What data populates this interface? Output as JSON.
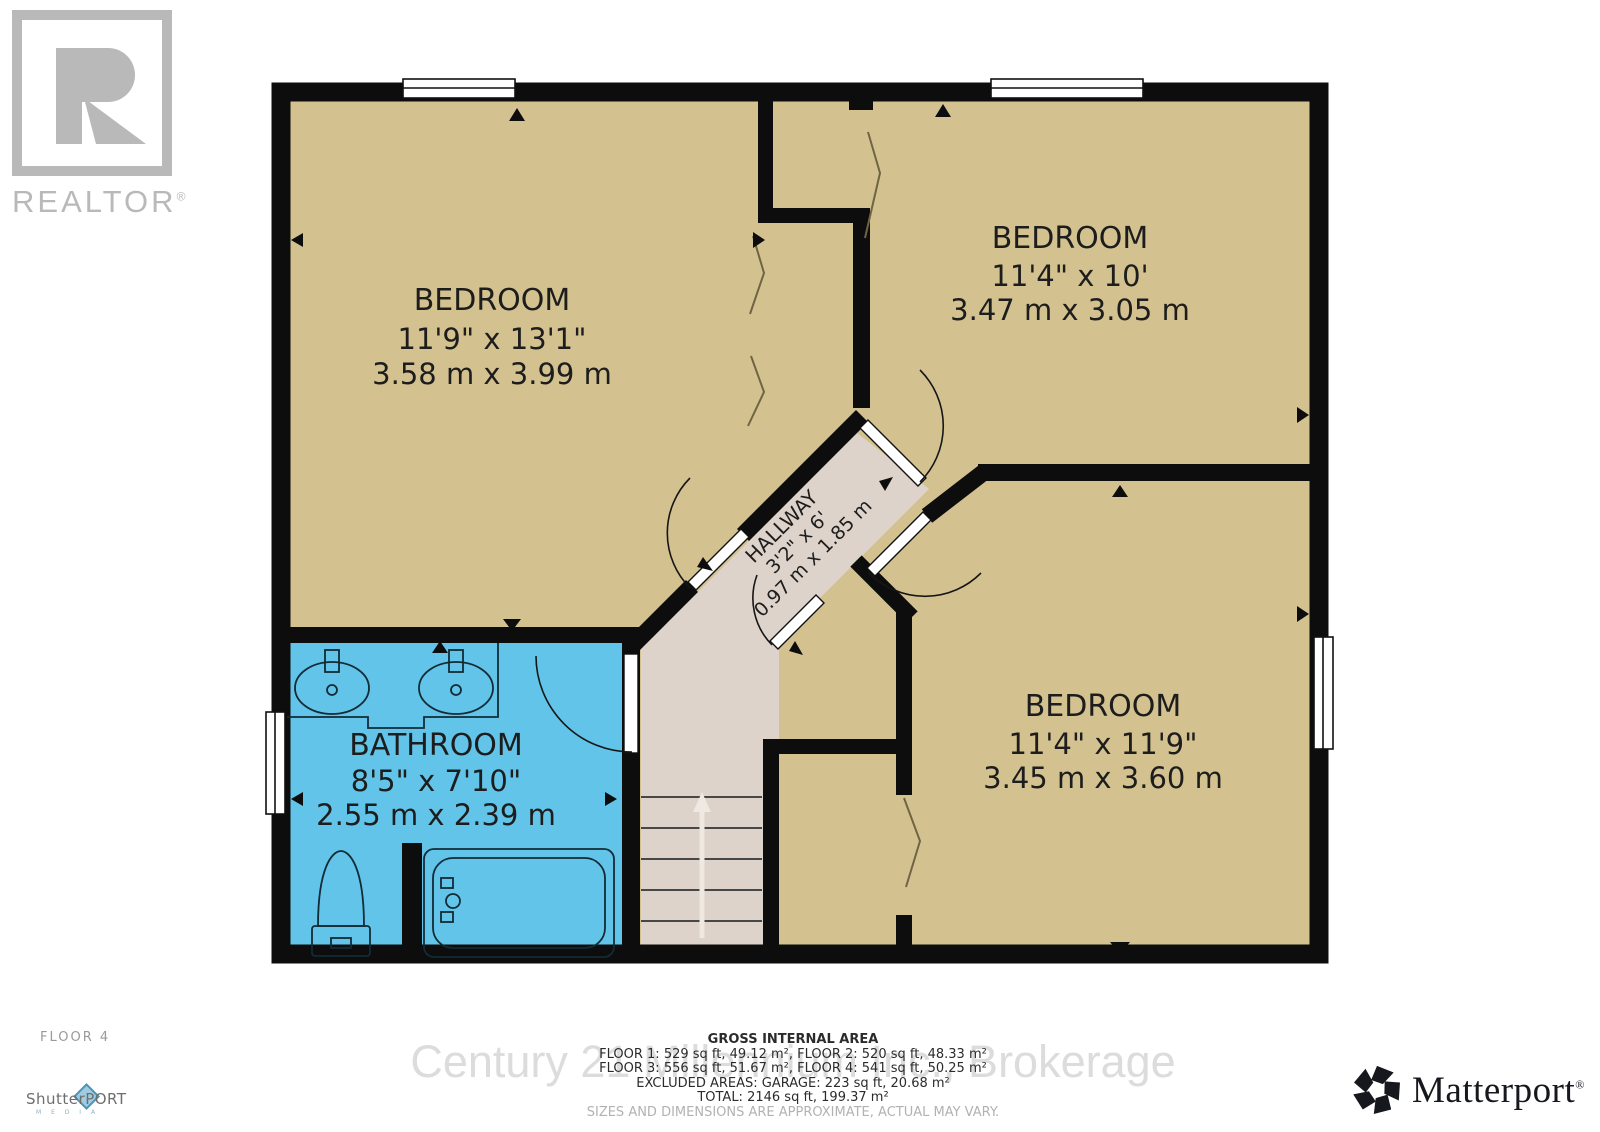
{
  "branding": {
    "realtor_wordmark": "REALTOR",
    "realtor_reg": "®",
    "shutterport_wordmark": "ShutterPORT",
    "shutterport_sub": "M E D I A",
    "matterport_wordmark": "Matterport",
    "matterport_reg": "®"
  },
  "floor_label": "FLOOR 4",
  "watermark": "Century 21 Millennium Inc., Brokerage",
  "rooms": {
    "bedroom_top_left": {
      "name": "BEDROOM",
      "dim_ft": "11'9\" x 13'1\"",
      "dim_m": "3.58 m x 3.99 m"
    },
    "bedroom_top_right": {
      "name": "BEDROOM",
      "dim_ft": "11'4\" x 10'",
      "dim_m": "3.47 m x 3.05 m"
    },
    "bedroom_bottom_right": {
      "name": "BEDROOM",
      "dim_ft": "11'4\" x 11'9\"",
      "dim_m": "3.45 m x 3.60 m"
    },
    "bathroom": {
      "name": "BATHROOM",
      "dim_ft": "8'5\" x 7'10\"",
      "dim_m": "2.55 m x 2.39 m"
    },
    "hallway": {
      "name": "HALLWAY",
      "dim_ft": "3'2\" x 6'",
      "dim_m": "0.97 m x 1.85 m"
    }
  },
  "footer": {
    "title": "GROSS INTERNAL AREA",
    "line1": "FLOOR 1: 529 sq ft, 49.12 m², FLOOR 2: 520 sq ft, 48.33 m²",
    "line2": "FLOOR 3: 556 sq ft, 51.67 m², FLOOR 4: 541 sq ft, 50.25 m²",
    "line3": "EXCLUDED AREAS: GARAGE: 223 sq ft, 20.68 m²",
    "line4": "TOTAL: 2146 sq ft, 199.37 m²",
    "disclaimer": "SIZES AND DIMENSIONS ARE APPROXIMATE, ACTUAL MAY VARY."
  },
  "colors": {
    "room_fill": "#d3c28f",
    "hallway_fill": "#ded3ca",
    "bathroom_fill": "#62c4e8",
    "wall": "#0d0d0d",
    "label_text": "#1d1d1d",
    "logo_gray": "#b9b9b9",
    "watermark_gray": "#dcdcdc"
  }
}
